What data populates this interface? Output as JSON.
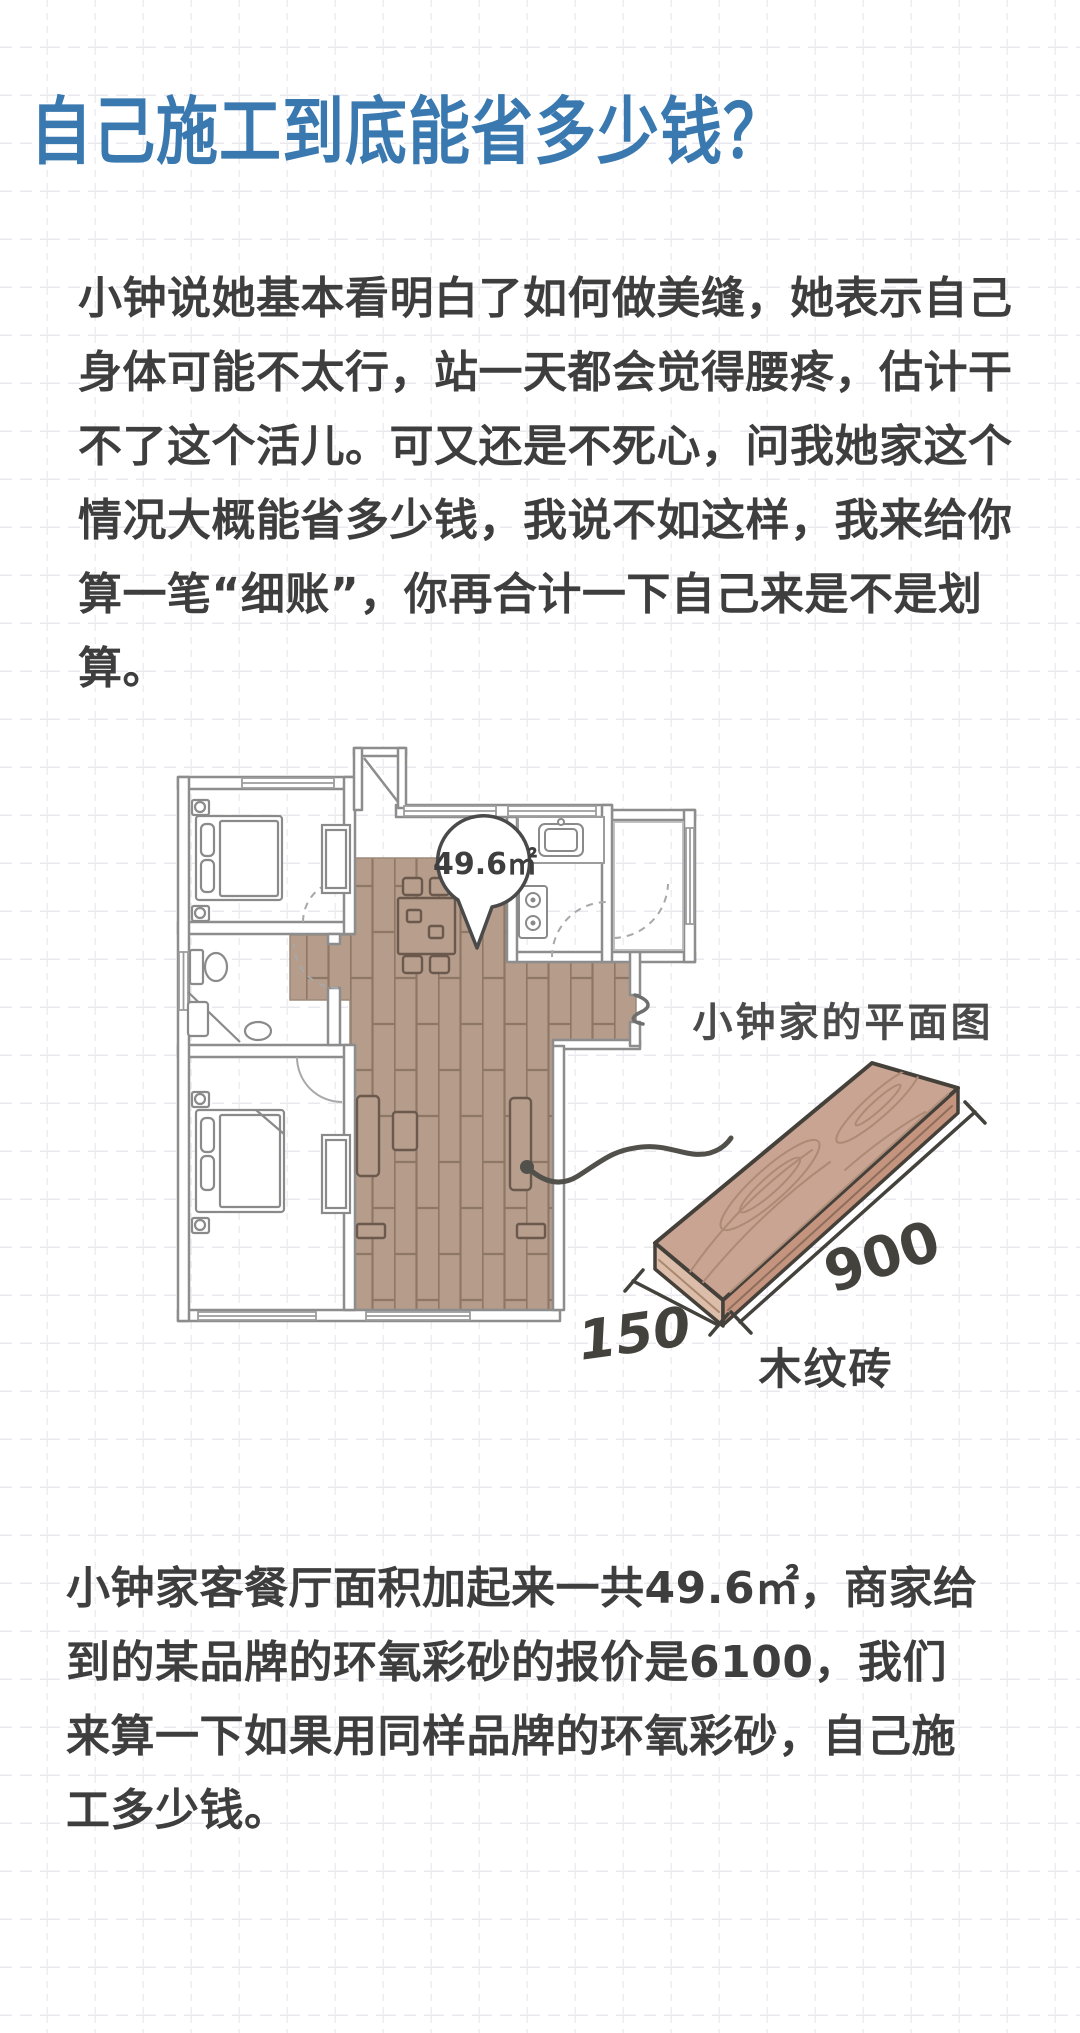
{
  "title": "自己施工到底能省多少钱？",
  "intro": "小钟说她基本看明白了如何做美缝，她表示自己\n身体可能不太行，站一天都会觉得腰疼，估计干\n不了这个活儿。可又还是不死心，问我她家这个\n情况大概能省多少钱，我说不如这样，我来给你\n算一笔“细账”，你再合计一下自己来是不是划算。",
  "floor_plan": {
    "area_bubble": "49.6㎡",
    "caption": "小钟家的平面图"
  },
  "tile": {
    "width": "150",
    "length": "900",
    "label": "木纹砖"
  },
  "closing": "小钟家客餐厅面积加起来一共49.6㎡，商家给\n到的某品牌的环氧彩砂的报价是6100，我们\n来算一下如果用同样品牌的环氧彩砂，自己施\n工多少钱。",
  "colors": {
    "title_blue": "#3a79b0",
    "body_text": "#3e3e3e",
    "wall_gray": "#8d8d8d",
    "tile_brown": "#b59c8b",
    "tile_seam": "#8f7765",
    "plank_wood": "#c9a492",
    "ink": "#45413a"
  }
}
